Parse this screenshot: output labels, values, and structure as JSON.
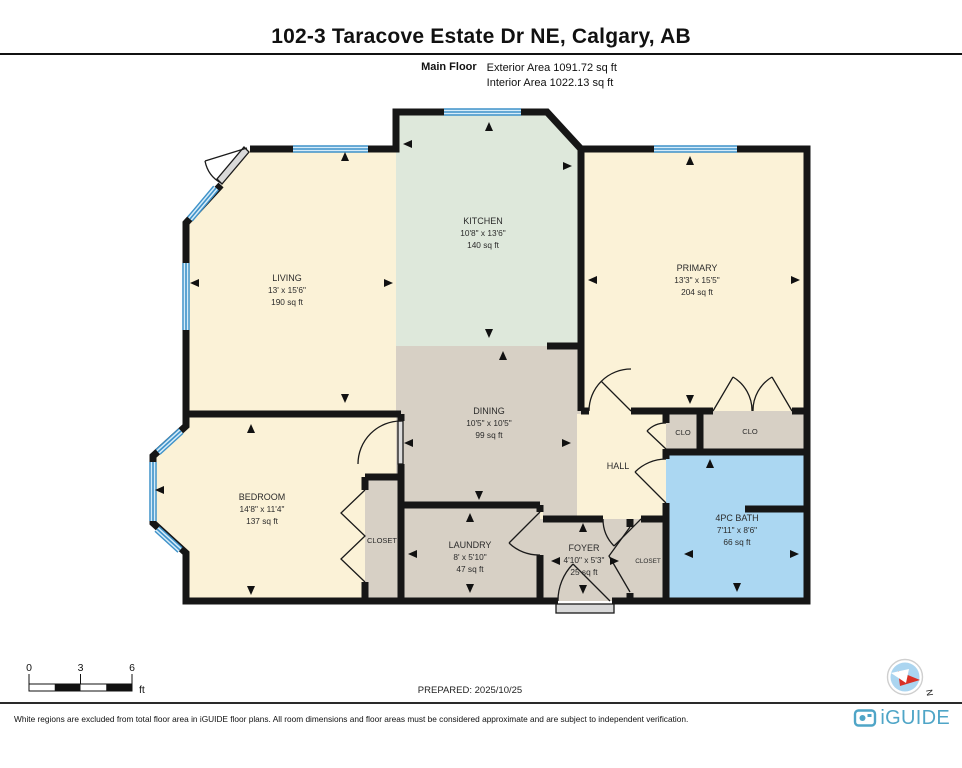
{
  "header": {
    "title": "102-3 Taracove Estate Dr NE, Calgary, AB",
    "floor_label": "Main Floor",
    "exterior_area": "Exterior Area 1091.72 sq ft",
    "interior_area": "Interior Area 1022.13 sq ft"
  },
  "rooms": {
    "living": {
      "name": "LIVING",
      "dims": "13' x 15'6\"",
      "area": "190 sq ft"
    },
    "kitchen": {
      "name": "KITCHEN",
      "dims": "10'8\" x 13'6\"",
      "area": "140 sq ft"
    },
    "primary": {
      "name": "PRIMARY",
      "dims": "13'3\" x 15'5\"",
      "area": "204 sq ft"
    },
    "dining": {
      "name": "DINING",
      "dims": "10'5\" x 10'5\"",
      "area": "99 sq ft"
    },
    "bedroom": {
      "name": "BEDROOM",
      "dims": "14'8\" x 11'4\"",
      "area": "137 sq ft"
    },
    "laundry": {
      "name": "LAUNDRY",
      "dims": "8' x 5'10\"",
      "area": "47 sq ft"
    },
    "foyer": {
      "name": "FOYER",
      "dims": "4'10\" x 5'3\"",
      "area": "25 sq ft"
    },
    "bath": {
      "name": "4PC BATH",
      "dims": "7'11\" x 8'6\"",
      "area": "66 sq ft"
    },
    "hall": {
      "name": "HALL"
    },
    "closet_bedroom": {
      "name": "CLOSET"
    },
    "closet_entry": {
      "name": "CLOSET"
    },
    "clo_1": {
      "name": "CLO"
    },
    "clo_2": {
      "name": "CLO"
    }
  },
  "scale_bar": {
    "tick_labels": [
      "0",
      "3",
      "6"
    ],
    "unit": "ft"
  },
  "prepared_label": "PREPARED: 2025/10/25",
  "compass": {
    "north_label": "N"
  },
  "footer": {
    "disclaimer": "White regions are excluded from total floor area in iGUIDE floor plans. All room dimensions and floor areas must be considered approximate and are subject to independent verification.",
    "brand": "iGUIDE"
  },
  "colors": {
    "room_cream": "#FBF2D7",
    "room_mint": "#DEE8DB",
    "room_grey": "#D7D0C5",
    "room_bath_blue": "#ABD7F2",
    "window_blue": "#3E92C9",
    "wall": "#161616",
    "brand_blue": "#4FA5C7"
  }
}
